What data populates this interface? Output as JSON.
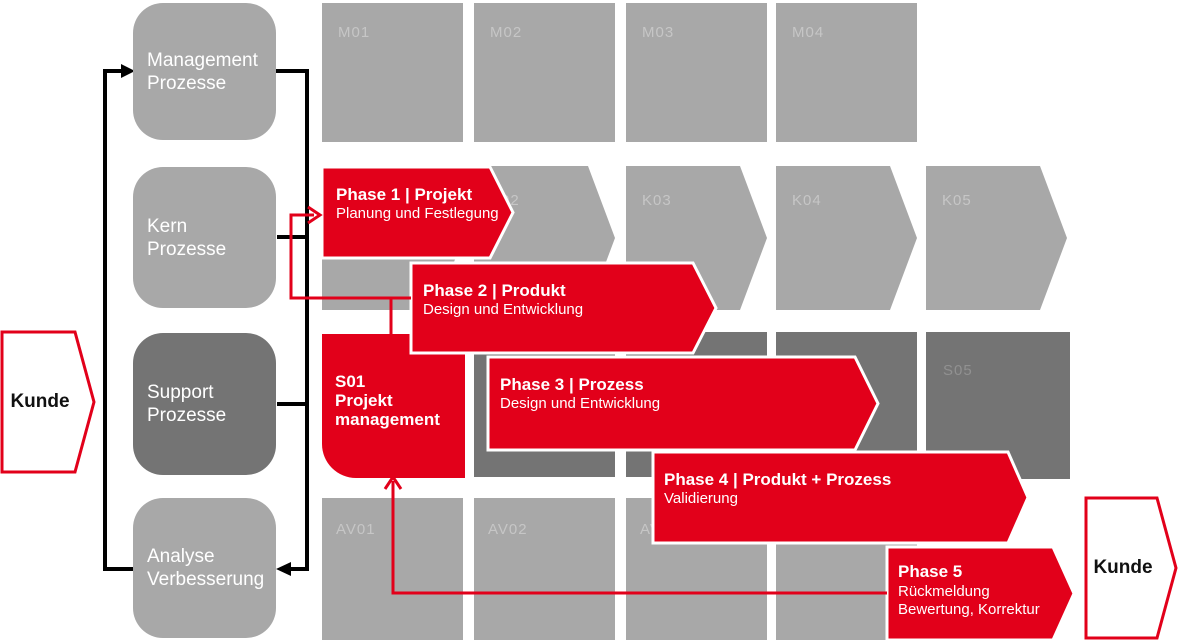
{
  "colors": {
    "accent_red": "#e2001a",
    "light_gray": "#a8a8a8",
    "dark_gray": "#747474",
    "label_on_light": "#c6c6c6",
    "label_on_dark": "#919191",
    "line_black": "#000000",
    "white": "#ffffff"
  },
  "customer_left": {
    "label": "Kunde"
  },
  "customer_right": {
    "label": "Kunde"
  },
  "process_house": {
    "management": {
      "line1": "Management",
      "line2": "Prozesse"
    },
    "kern": {
      "line1": "Kern",
      "line2": "Prozesse"
    },
    "support": {
      "line1": "Support",
      "line2": "Prozesse"
    },
    "analyse": {
      "line1": "Analyse",
      "line2": "Verbesserung"
    }
  },
  "grid": {
    "m_row": [
      "M01",
      "M02",
      "M03",
      "M04"
    ],
    "k_row": [
      "K01",
      "K02",
      "K03",
      "K04",
      "K05"
    ],
    "s_row": {
      "s05": "S05"
    },
    "av_row": [
      "AV01",
      "AV02",
      "AV03",
      "AV04"
    ]
  },
  "s01": {
    "line1": "S01",
    "line2": "Projekt",
    "line3": "management"
  },
  "phases": [
    {
      "title": "Phase 1 | Projekt",
      "subtitle": "Planung und Festlegung"
    },
    {
      "title": "Phase 2 | Produkt",
      "subtitle": "Design und Entwicklung"
    },
    {
      "title": "Phase 3 | Prozess",
      "subtitle": "Design und Entwicklung"
    },
    {
      "title": "Phase 4 | Produkt + Prozess",
      "subtitle": "Validierung"
    },
    {
      "title": "Phase 5",
      "subtitle": "Rückmeldung",
      "subtitle2": "Bewertung, Korrektur"
    }
  ]
}
